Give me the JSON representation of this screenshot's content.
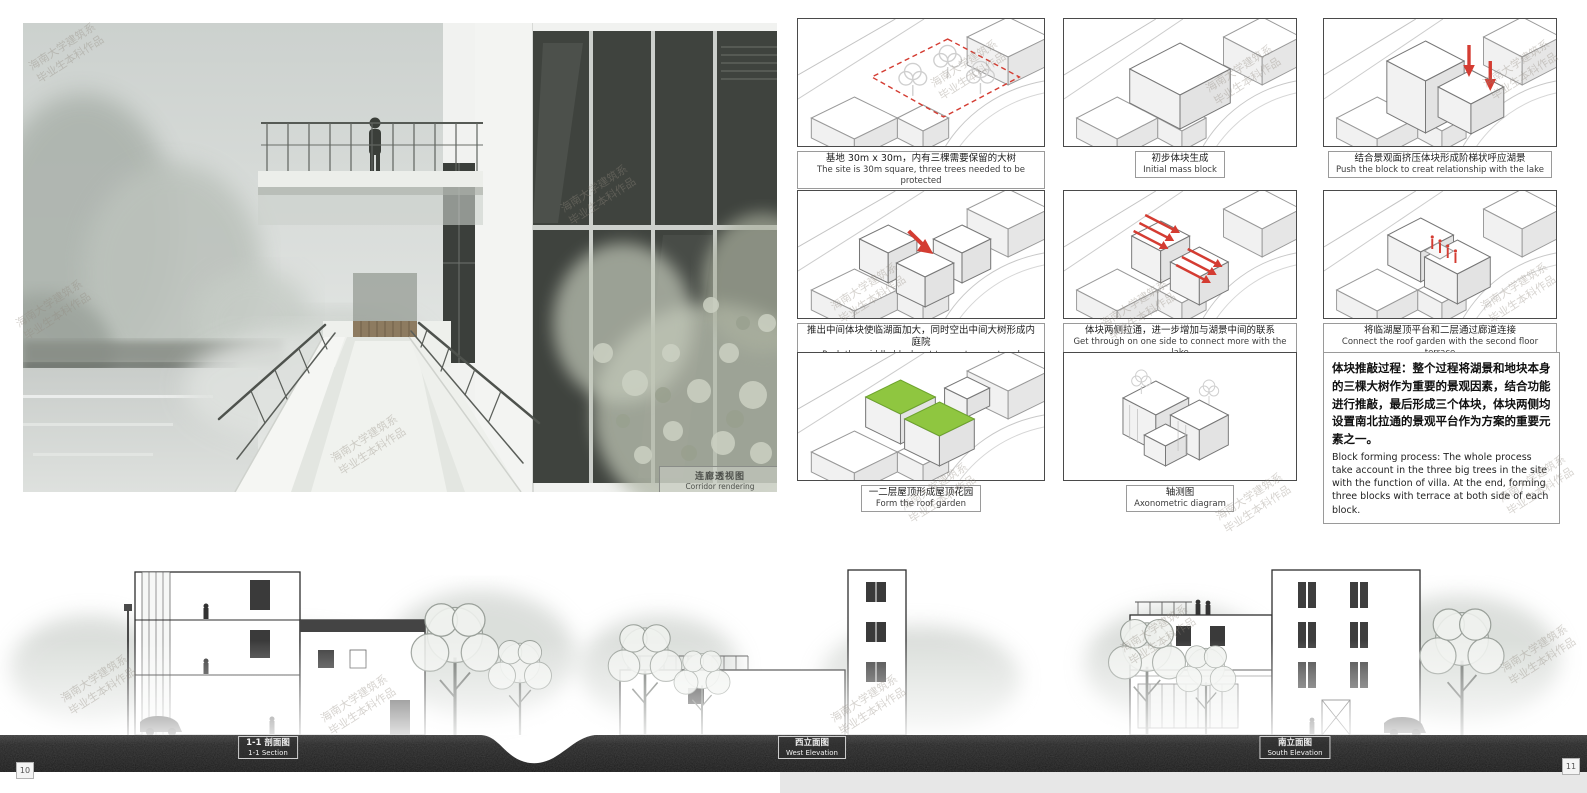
{
  "board": {
    "watermark": {
      "line1": "海南大学建筑系",
      "line2": "毕业生本科作品"
    },
    "page_numbers": {
      "left": "10",
      "right": "11"
    }
  },
  "rendering": {
    "caption_zh": "连廊透视图",
    "caption_en": "Corridor rendering"
  },
  "diagrams": [
    {
      "zh": "基地 30m x 30m，内有三棵需要保留的大树",
      "en": "The site is 30m square, three trees needed to be protected"
    },
    {
      "zh": "初步体块生成",
      "en": "Initial mass block"
    },
    {
      "zh": "结合景观面挤压体块形成阶梯状呼应湖景",
      "en": "Push the block to creat relationship with the lake"
    },
    {
      "zh": "推出中间体块使临湖面加大，同时空出中间大树形成内庭院",
      "en": "Push the middle block out to creat a courtyard"
    },
    {
      "zh": "体块两侧拉通，进一步增加与湖景中间的联系",
      "en": "Get through on one side to connect more with the lake"
    },
    {
      "zh": "将临湖屋顶平台和二层通过廊道连接",
      "en": "Connect the roof garden with the second floor terrace"
    },
    {
      "zh": "一二层屋顶形成屋顶花园",
      "en": "Form the roof garden"
    },
    {
      "zh": "轴测图",
      "en": "Axonometric diagram"
    }
  ],
  "process_note": {
    "zh": "体块推敲过程：整个过程将湖景和地块本身的三棵大树作为重要的景观因素，结合功能进行推敲，最后形成三个体块，体块两侧均设置南北拉通的景观平台作为方案的重要元素之一。",
    "en": "Block forming process: The whole process take account in the three big trees in the site with the function of villa. At the end, forming three blocks with terrace at both side of each block."
  },
  "elevations": [
    {
      "zh": "1-1 剖面图",
      "en": "1-1 Section"
    },
    {
      "zh": "西立面图",
      "en": "West Elevation"
    },
    {
      "zh": "南立面图",
      "en": "South Elevation"
    }
  ],
  "colors": {
    "accent_red": "#d43c32",
    "roof_green": "#8fc640"
  }
}
